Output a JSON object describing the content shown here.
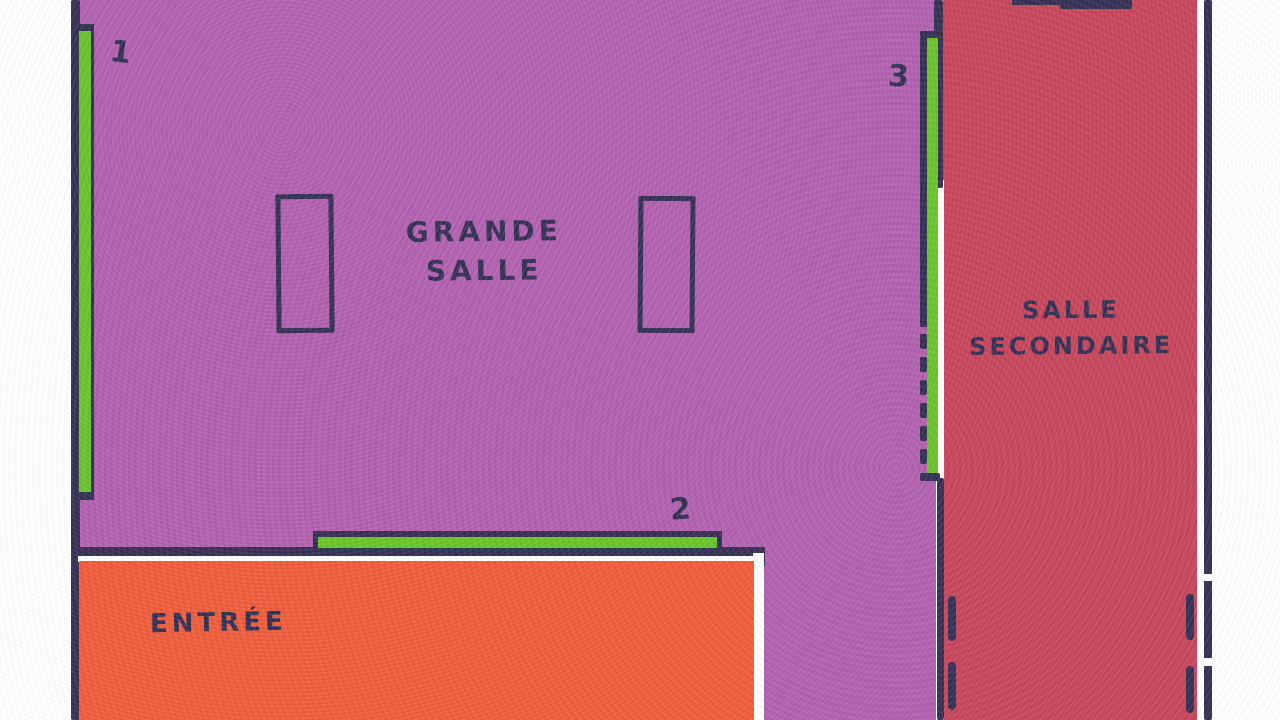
{
  "colors": {
    "paper": "#ffffff",
    "ink": "#312e52",
    "grande_salle_fill": "#b15fae",
    "salle_secondaire_fill": "#c64459",
    "entree_fill": "#ee5b38",
    "strip_green": "#68c32a"
  },
  "rooms": {
    "grande_salle": {
      "name_line1": "GRANDE",
      "name_line2": "SALLE"
    },
    "salle_secondaire": {
      "name_line1": "SALLE",
      "name_line2": "SECONDAIRE"
    },
    "entree": {
      "name": "ENTRÉE"
    }
  },
  "markers": {
    "strip1": {
      "label": "1"
    },
    "strip2": {
      "label": "2"
    },
    "strip3": {
      "label": "3"
    }
  }
}
